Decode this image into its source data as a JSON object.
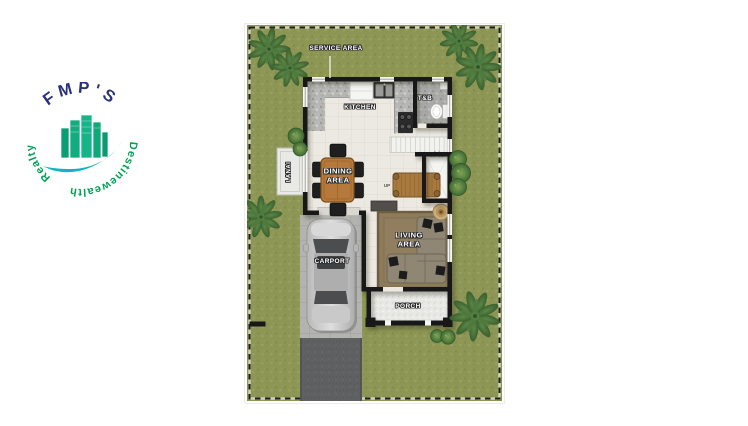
{
  "logo": {
    "arc_top_text": "FMP'S",
    "arc_left_text": "Realty",
    "arc_right_text": "Destinewealth",
    "navy": "#28307c",
    "green": "#00a155",
    "teal": "#16b2bd",
    "building_green": "#12ac80"
  },
  "floorplan": {
    "labels": {
      "service_area": "SERVICE AREA",
      "kitchen": "KITCHEN",
      "toilet_bath": "T&B",
      "lanai": "LANAI",
      "dining_area": "DINING\nAREA",
      "living_area": "LIVING\nAREA",
      "carport": "CARPORT",
      "porch": "PORCH",
      "stairs": "UP"
    },
    "colors": {
      "grass": "#8e9656",
      "wall": "#181818",
      "floor": "#ece9e2",
      "counter_marble": "#b6b6b4",
      "carport_pavers": "#b3b3b0",
      "driveway": "#5e6062",
      "porch": "#e8e8e5",
      "lanai": "#e9e9e5",
      "wood_furniture": "#b5793b",
      "rug": "#8d7b5a",
      "sofa": "#8f8673",
      "foliage": "#46703a",
      "car": "#c4c4c4"
    }
  }
}
